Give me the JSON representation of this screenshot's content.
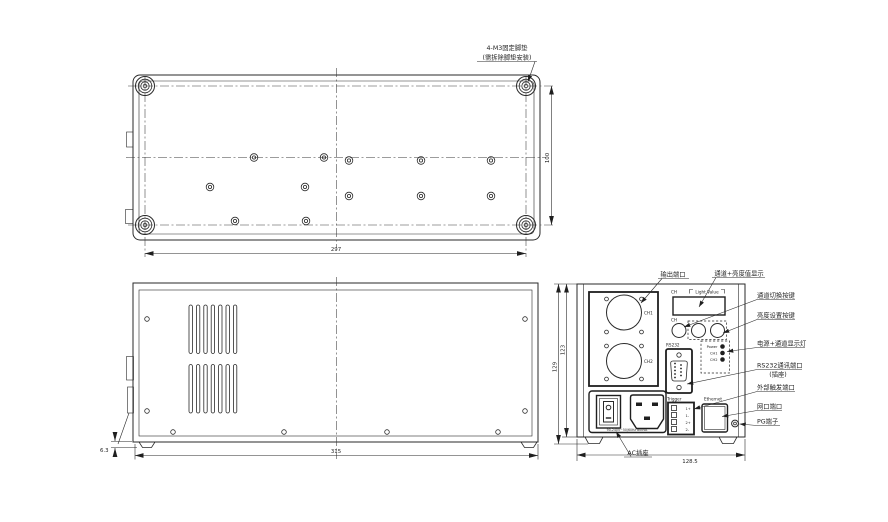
{
  "top_view": {
    "foot_note_line1": "4-M3固定脚垫",
    "foot_note_line2": "(需拆除脚垫安装)",
    "dim_width": "297",
    "dim_depth": "100"
  },
  "side_view": {
    "dim_length": "315",
    "dim_foot": "6.3"
  },
  "front_view": {
    "dim_width": "128.5",
    "dim_height_outer": "129",
    "dim_height_inner": "123",
    "panel": {
      "display_ch": "CH",
      "display_value": "Light Value",
      "button_ch": "CH",
      "rs232": "RS232",
      "trigger": "Trigger",
      "ethernet": "Ethernet",
      "output_ch1": "CH1",
      "output_ch2": "CH2",
      "led_labels": [
        "Power",
        "CH1",
        "CH2"
      ],
      "trigger_pins": [
        "1+",
        "1-",
        "2+",
        "2-"
      ],
      "ac_rating": "90-240V~50/60Hz 800VA"
    },
    "callouts": {
      "output_port": "输出端口",
      "display": "通道+亮度值显示",
      "channel_button": "通道切换按键",
      "brightness_button": "亮度设置按键",
      "leds": "电源+通道显示灯",
      "rs232_line1": "RS232通讯端口",
      "rs232_line2": "(插座)",
      "trigger": "外部触发端口",
      "ethernet": "网口端口",
      "pg": "PG端子",
      "ac": "AC插座"
    }
  }
}
